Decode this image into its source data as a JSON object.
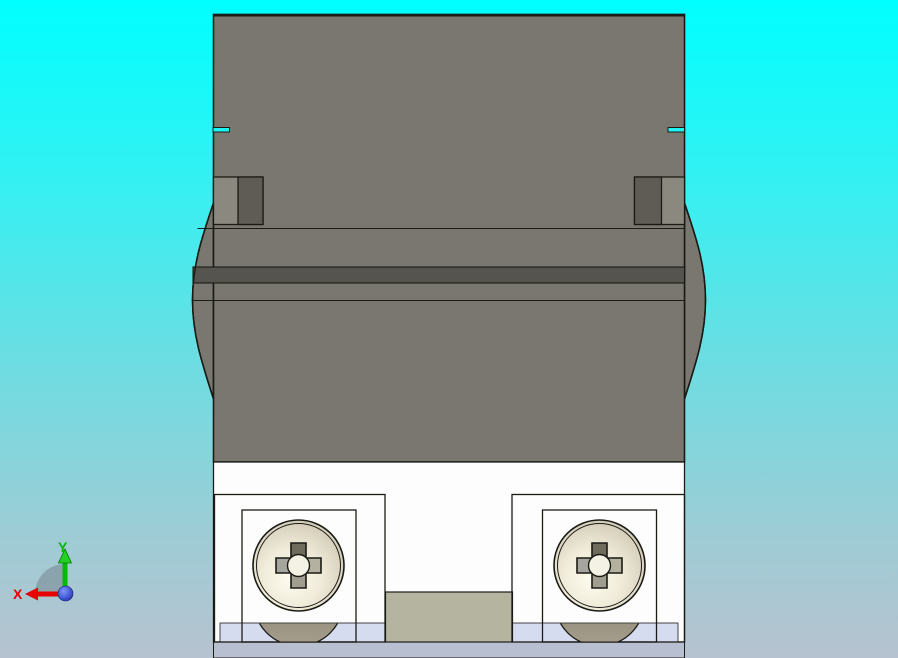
{
  "app": {
    "description": "CAD 3D viewport, orthographic front view of clamp block part with two Phillips pan-head screws"
  },
  "triad": {
    "x_label": "X",
    "y_label": "Y"
  },
  "colors": {
    "bg_top": "#00ffff",
    "bg_hi": "#35f0f2",
    "bg_mid": "#6cdde2",
    "bg_low": "#9ccdd6",
    "bg_bottom": "#b6c2cf",
    "edge": "#1b1b15",
    "body": "#7a7771",
    "clamp_light": "#8b887f",
    "clamp_dark": "#5e5c55",
    "stripe": "#55544e",
    "notch": "#1ef4f5",
    "plate": "#fdfdfd",
    "lavender": "#b7bfd0",
    "blue_strip": "#d6dcf0",
    "khaki": "#b4b4a0",
    "head_hi": "#fffdf0",
    "head_mid": "#efead8",
    "head_lo": "#d0cab6",
    "head_rim": "#c0baa5",
    "lower_top": "#7d7665",
    "lower_bot": "#a59e8c",
    "cross_top": "#6f6b5d",
    "cross_left": "#a7a69e",
    "cross_right": "#b4b1a1",
    "cross_bottom": "#a29e8f",
    "cross_center": "#f4f2e4",
    "axis_x": "#e60000",
    "axis_y": "#00bb00",
    "axis_y_head": "#22d022",
    "axis_z_hi": "#7c96ff",
    "axis_z_lo": "#1b2cae",
    "wedge": "#6f7d88"
  }
}
